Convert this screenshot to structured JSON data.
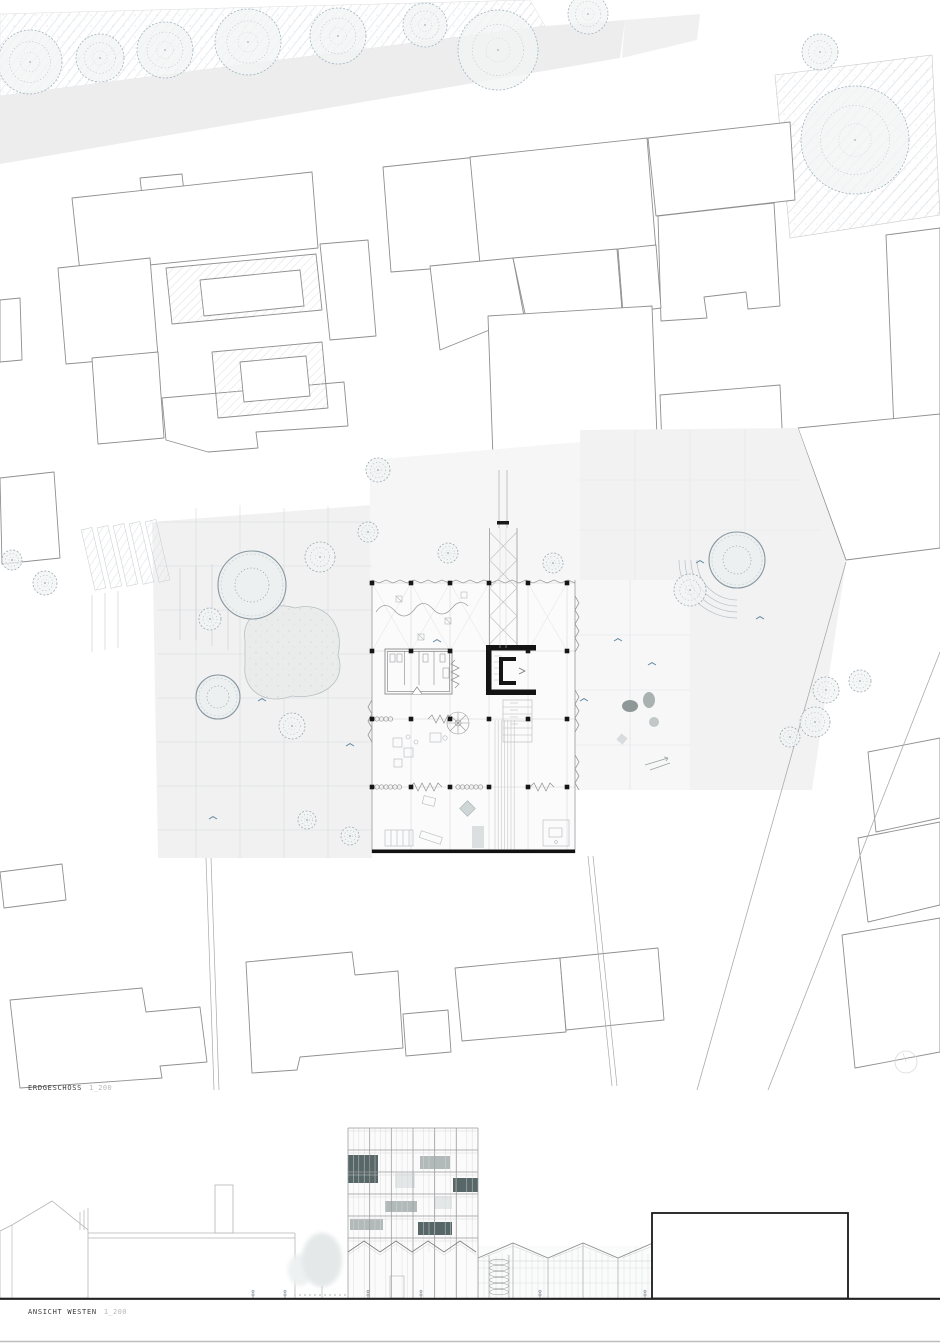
{
  "sheet": {
    "type": "architectural-drawing-sheet",
    "background": "#ffffff"
  },
  "labels": {
    "plan": {
      "title": "ERDGESCHOSS",
      "scale": "1_200"
    },
    "elevation": {
      "title": "ANSICHT WESTEN",
      "scale": "1_200"
    }
  },
  "palette": {
    "outline_grey": "#8f8f8f",
    "context_outline": "#b5b5b5",
    "band_grey": "#ededee",
    "paving_grey": "#f1f1f2",
    "hatch_grey": "#d9dce1",
    "tree_street": "#9db3bf",
    "tree_plan": "#97a8b1",
    "ink_black": "#161616",
    "panel_dark": "#4e5f60",
    "panel_light": "#aeb6b5",
    "panel_pale": "#e2e6e6",
    "accent_blue": "#5f87a0"
  },
  "plan": {
    "columns": {
      "xs": [
        372,
        411,
        450,
        489,
        528,
        567
      ],
      "ys": [
        583,
        651,
        719,
        787
      ],
      "size": 4.6
    },
    "trees": [
      {
        "cx": 30,
        "cy": 62,
        "r": 32,
        "k": "street"
      },
      {
        "cx": 100,
        "cy": 58,
        "r": 24,
        "k": "street"
      },
      {
        "cx": 165,
        "cy": 50,
        "r": 28,
        "k": "street"
      },
      {
        "cx": 248,
        "cy": 42,
        "r": 33,
        "k": "street"
      },
      {
        "cx": 338,
        "cy": 36,
        "r": 28,
        "k": "street"
      },
      {
        "cx": 425,
        "cy": 25,
        "r": 22,
        "k": "street"
      },
      {
        "cx": 498,
        "cy": 50,
        "r": 40,
        "k": "street"
      },
      {
        "cx": 588,
        "cy": 14,
        "r": 20,
        "k": "street"
      },
      {
        "cx": 855,
        "cy": 140,
        "r": 54,
        "k": "street"
      },
      {
        "cx": 820,
        "cy": 52,
        "r": 18,
        "k": "street"
      },
      {
        "cx": 252,
        "cy": 585,
        "r": 34,
        "k": "planter"
      },
      {
        "cx": 218,
        "cy": 697,
        "r": 22,
        "k": "planter"
      },
      {
        "cx": 737,
        "cy": 560,
        "r": 28,
        "k": "planter"
      },
      {
        "cx": 320,
        "cy": 557,
        "r": 15,
        "k": "tree"
      },
      {
        "cx": 292,
        "cy": 726,
        "r": 13,
        "k": "tree"
      },
      {
        "cx": 378,
        "cy": 470,
        "r": 12,
        "k": "tree"
      },
      {
        "cx": 368,
        "cy": 532,
        "r": 10,
        "k": "tree"
      },
      {
        "cx": 448,
        "cy": 553,
        "r": 10,
        "k": "tree"
      },
      {
        "cx": 553,
        "cy": 563,
        "r": 10,
        "k": "tree"
      },
      {
        "cx": 690,
        "cy": 590,
        "r": 16,
        "k": "tree"
      },
      {
        "cx": 826,
        "cy": 690,
        "r": 13,
        "k": "tree"
      },
      {
        "cx": 860,
        "cy": 681,
        "r": 11,
        "k": "tree"
      },
      {
        "cx": 815,
        "cy": 722,
        "r": 15,
        "k": "tree"
      },
      {
        "cx": 790,
        "cy": 737,
        "r": 10,
        "k": "tree"
      },
      {
        "cx": 12,
        "cy": 560,
        "r": 10,
        "k": "tree"
      },
      {
        "cx": 45,
        "cy": 583,
        "r": 12,
        "k": "tree"
      },
      {
        "cx": 210,
        "cy": 619,
        "r": 11,
        "k": "tree"
      },
      {
        "cx": 307,
        "cy": 820,
        "r": 9,
        "k": "tree"
      },
      {
        "cx": 350,
        "cy": 836,
        "r": 9,
        "k": "tree"
      }
    ],
    "birds": [
      {
        "x": 213,
        "y": 818
      },
      {
        "x": 262,
        "y": 700
      },
      {
        "x": 437,
        "y": 641
      },
      {
        "x": 618,
        "y": 640
      },
      {
        "x": 652,
        "y": 664
      },
      {
        "x": 700,
        "y": 562
      },
      {
        "x": 584,
        "y": 700
      },
      {
        "x": 350,
        "y": 745
      },
      {
        "x": 760,
        "y": 618
      }
    ]
  },
  "elevation": {
    "ground_y": 198,
    "tower": {
      "x": 348,
      "y": 28,
      "w": 130,
      "h": 124,
      "floors": 6
    },
    "panels": [
      {
        "x": 348,
        "y": 55,
        "w": 30,
        "h": 28,
        "tone": "dark"
      },
      {
        "x": 453,
        "y": 78,
        "w": 25,
        "h": 14,
        "tone": "dark"
      },
      {
        "x": 418,
        "y": 122,
        "w": 34,
        "h": 13,
        "tone": "dark"
      },
      {
        "x": 420,
        "y": 56,
        "w": 30,
        "h": 13,
        "tone": "light"
      },
      {
        "x": 385,
        "y": 101,
        "w": 32,
        "h": 11,
        "tone": "light"
      },
      {
        "x": 350,
        "y": 119,
        "w": 33,
        "h": 11,
        "tone": "light"
      },
      {
        "x": 395,
        "y": 73,
        "w": 20,
        "h": 15,
        "tone": "pale"
      },
      {
        "x": 434,
        "y": 96,
        "w": 18,
        "h": 13,
        "tone": "pale"
      }
    ],
    "people_x": [
      253,
      285,
      368,
      421,
      540,
      645
    ]
  }
}
